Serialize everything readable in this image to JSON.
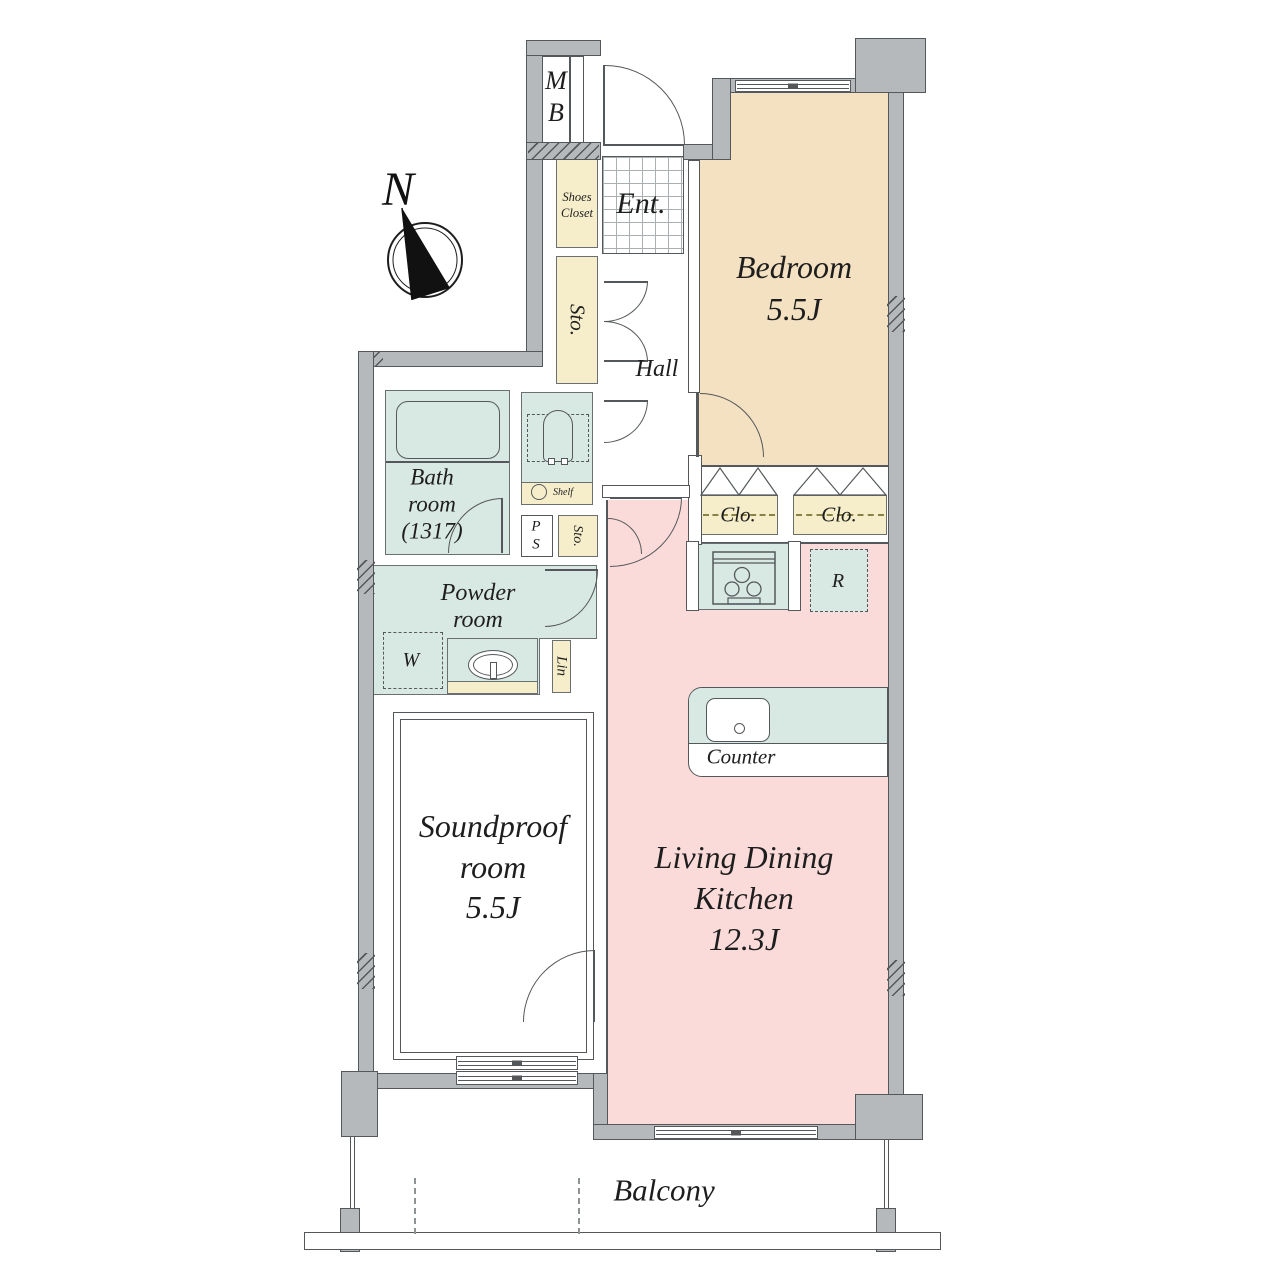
{
  "compass": {
    "label": "N"
  },
  "entrance": {
    "label": "Ent.",
    "meter_box": [
      "M",
      "B"
    ],
    "shoes_closet": [
      "Shoes",
      "Closet"
    ]
  },
  "hall": {
    "label": "Hall",
    "storage": "Sto."
  },
  "bedroom": {
    "label": "Bedroom",
    "size": "5.5J",
    "closet_left": "Clo.",
    "closet_right": "Clo."
  },
  "sanitary": {
    "bathroom": [
      "Bath",
      "room",
      "(1317)"
    ],
    "toilet_shelf": "Shelf",
    "pipe_space": [
      "P",
      "S"
    ],
    "storage_small": "Sto.",
    "powder_room": [
      "Powder",
      "room"
    ],
    "washer": "W",
    "linen": "Lin"
  },
  "soundproof_room": {
    "label": [
      "Soundproof",
      "room"
    ],
    "size": "5.5J"
  },
  "ldk": {
    "label": [
      "Living Dining",
      "Kitchen"
    ],
    "size": "12.3J",
    "counter": "Counter",
    "refrigerator": "R"
  },
  "balcony": {
    "label": "Balcony"
  },
  "colors": {
    "wall_fill": "#b5b9bb",
    "wall_outline": "#54585a",
    "bedroom_fill": "#f3e1c2",
    "storage_fill": "#f6eecb",
    "wet_area_fill": "#d8e8e3",
    "ldk_fill": "#fadbd9",
    "text": "#1e1e1e"
  }
}
